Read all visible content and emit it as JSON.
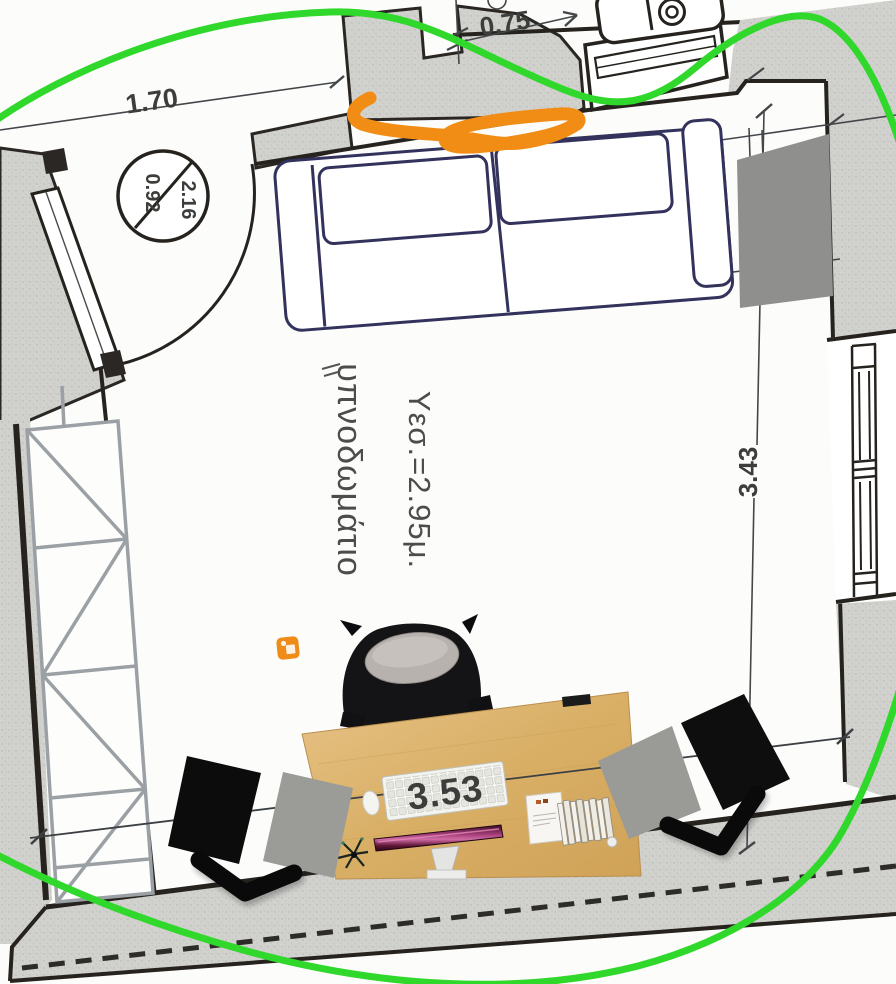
{
  "dimensions": {
    "top_wall": "1.70",
    "top_right_wall": "0.75",
    "door": {
      "width": "0.92",
      "height": "2.16"
    },
    "right_wall": "3.43",
    "bottom_wall": "3.53"
  },
  "room": {
    "name": "υπνοδωμάτιο",
    "ceiling_height": "Υεσ.=2.95μ."
  },
  "colors": {
    "annotation_green": "#2fd82b",
    "annotation_orange": "#f18c15",
    "wall_fill": "#d0d0cd",
    "plan_line": "#26231f",
    "closet_line": "#9aa0a4",
    "sofa_line": "#32325c",
    "desk_wood": "#d9b26c",
    "monitor_purple": "#8e2f63",
    "overlay_black": "#0d0d0d",
    "overlay_gray": "#9b9b97"
  }
}
